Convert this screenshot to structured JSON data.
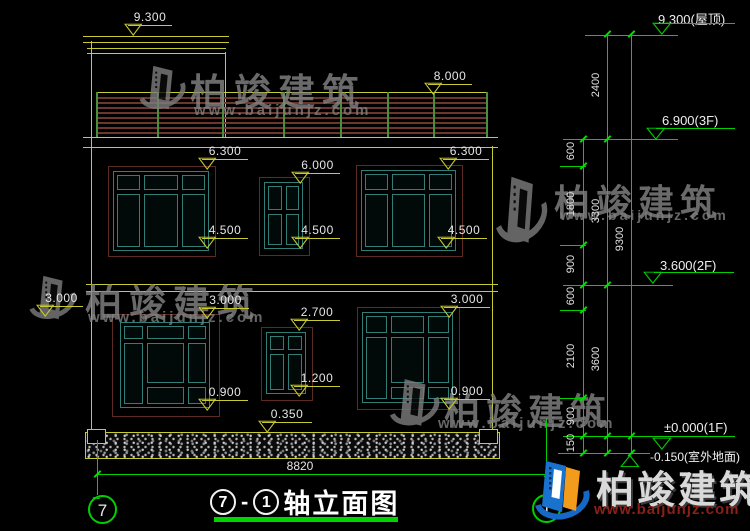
{
  "drawing_title": {
    "axis_left": "7",
    "dash": "-",
    "axis_right": "1",
    "name": "轴立面图"
  },
  "axes": {
    "left": "7",
    "right": "1"
  },
  "overall_width_dim": "8820",
  "elevation_markers": {
    "roof": "9.300",
    "railing_top": "8.000",
    "win2f_left_top": "6.300",
    "win2f_mid_top": "6.000",
    "win2f_right_top": "6.300",
    "win2f_left_sill": "4.500",
    "win2f_mid_sill": "4.500",
    "win2f_right_sill": "4.500",
    "wall_left": "3.000",
    "win1f_left_top": "3.000",
    "win1f_mid_top": "2.700",
    "win1f_right_top": "3.000",
    "win1f_left_sill": "0.900",
    "win1f_mid_sill": "1.200",
    "win1f_right_sill": "0.900",
    "plinth_top": "0.350"
  },
  "level_flags": {
    "roof": "9.300(屋顶)",
    "floor3": "6.900(3F)",
    "floor2": "3.600(2F)",
    "floor1": "±0.000(1F)",
    "ground": "-0.150(室外地面)"
  },
  "dim_chains": {
    "detail": [
      "600",
      "1800",
      "900",
      "600",
      "2100",
      "900",
      "150"
    ],
    "floors": [
      "2400",
      "3300",
      "3600"
    ],
    "overall": [
      "9300"
    ]
  },
  "watermark": {
    "brand": "柏竣建筑",
    "url": "www.baijunjz.com"
  },
  "footer_logo": {
    "brand": "柏竣建筑",
    "url": "www.baijunjz.com"
  },
  "glyphs": {
    "tri_down": "▽",
    "tri_up": "△",
    "tilde": "~"
  },
  "colors": {
    "line_yellow": "#c9c932",
    "dim_green": "#00cf00",
    "window_teal": "#2f7f78",
    "window_surround": "#5e2b22",
    "railing_slat": "#6b372c",
    "watermark_gray": "#858585",
    "logo_blue": "#1a6fc4",
    "logo_orange": "#f39b1b",
    "url_red": "#8a2018"
  }
}
